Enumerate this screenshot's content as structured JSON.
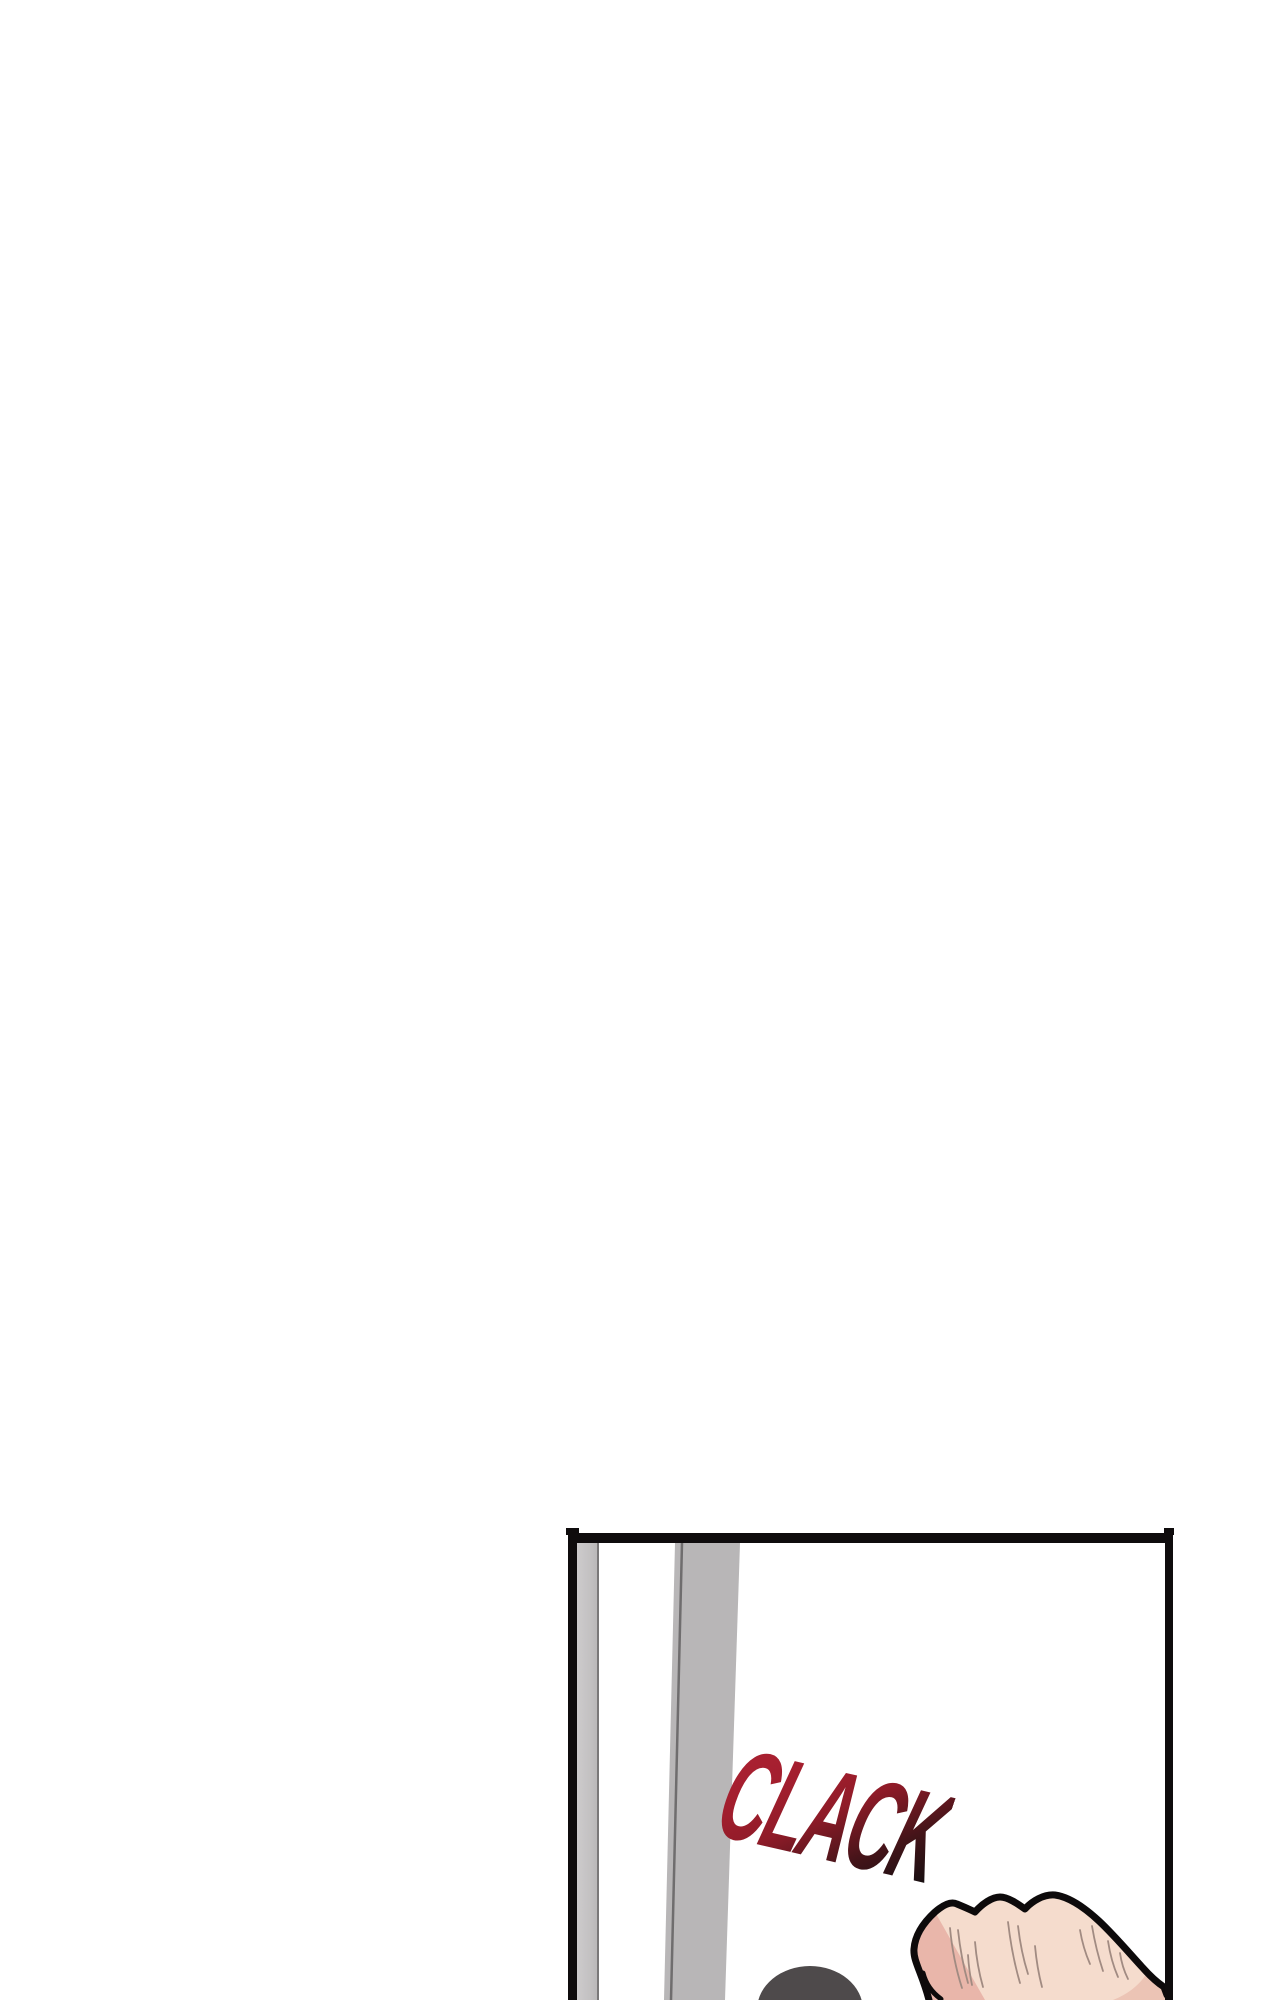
{
  "page": {
    "background_color": "#ffffff"
  },
  "panel": {
    "sfx_text": "CLACK",
    "colors": {
      "frame_border": "#0f0c0d",
      "door_frame_stripe_light": "#cdcbcc",
      "door_frame_stripe_dark": "#bab8b9",
      "door_frame_edge_line": "#7a7879",
      "door_edge_fill": "#b8b6b7",
      "door_edge_line": "#6f6d6e",
      "sfx_red_top": "#a92031",
      "sfx_red_mid": "#8f1b28",
      "sfx_dark_bottom": "#1a0f11",
      "head_hair": "#4e4a4b",
      "skin": "#f5dccd",
      "skin_shadow_left": "#e9b6aa",
      "skin_shadow_right": "#ecc4b5",
      "knuckle_crease": "#a18b82",
      "ink_outline": "#0d0a0b"
    }
  }
}
